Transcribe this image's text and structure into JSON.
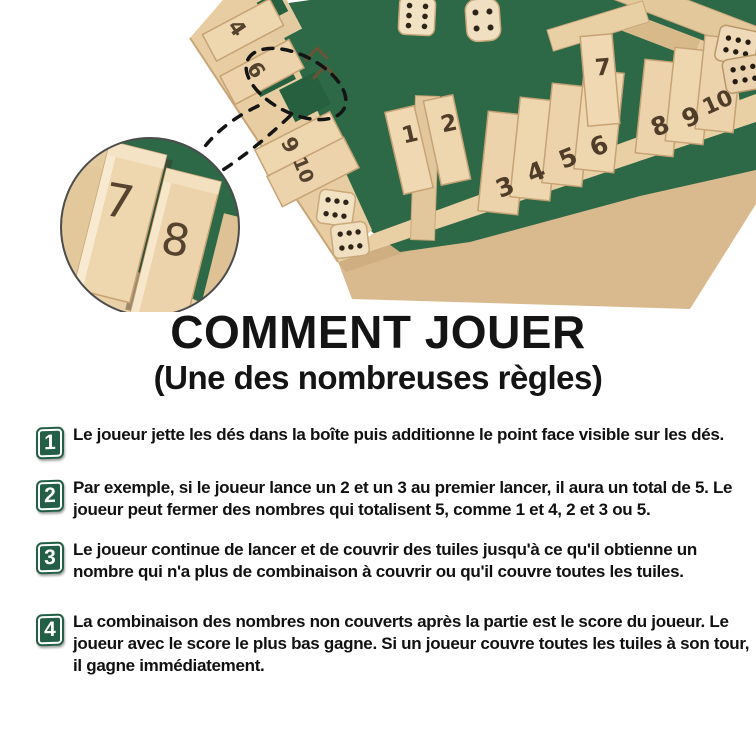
{
  "header": {
    "title": "COMMENT JOUER",
    "subtitle": "(Une des nombreuses règles)"
  },
  "photo": {
    "alt": "boîte en bois « Shut the Box » 4 joueurs avec feutre vert, tuiles numérotées et dés",
    "board_tile_numbers": {
      "bottom_row": [
        "1",
        "2",
        "3",
        "4",
        "5",
        "6",
        "7",
        "8",
        "9",
        "10"
      ],
      "left_rail": [
        "4",
        "6",
        "9",
        "10"
      ],
      "magnified_inset": [
        "7",
        "8"
      ]
    },
    "dice_faces": {
      "on_felt": [
        "6",
        "4"
      ],
      "inside_corner": [
        "6",
        "6"
      ],
      "right_edge": [
        "6",
        "6"
      ]
    }
  },
  "steps": [
    {
      "number": "1",
      "text": "Le joueur jette les dés dans la boîte puis additionne le point face visible sur les dés."
    },
    {
      "number": "2",
      "text": "Par exemple, si le joueur lance un 2 et un 3 au premier lancer, il aura un total de 5. Le joueur peut fermer des nombres qui totalisent 5, comme 1 et 4, 2 et 3 ou 5."
    },
    {
      "number": "3",
      "text": "Le joueur continue de lancer et de couvrir des tuiles jusqu'à ce qu'il obtienne un nombre qui n'a plus de combinaison à couvrir ou qu'il couvre toutes les tuiles."
    },
    {
      "number": "4",
      "text": "La combinaison des nombres non couverts après la partie est le score du joueur. Le joueur avec le score le plus bas gagne. Si un joueur couvre toutes les tuiles à son tour, il gagne immédiatement."
    }
  ],
  "colors": {
    "background": "#ffffff",
    "felt_green": "#2d6847",
    "felt_green_dark": "#27603f",
    "wood_light": "#ecd3ab",
    "wood_mid": "#e0c39a",
    "wood_dark": "#c9a87b",
    "badge_green": "#235f46",
    "text_black": "#141414",
    "tile_digit_brown": "#4f3d2a"
  }
}
